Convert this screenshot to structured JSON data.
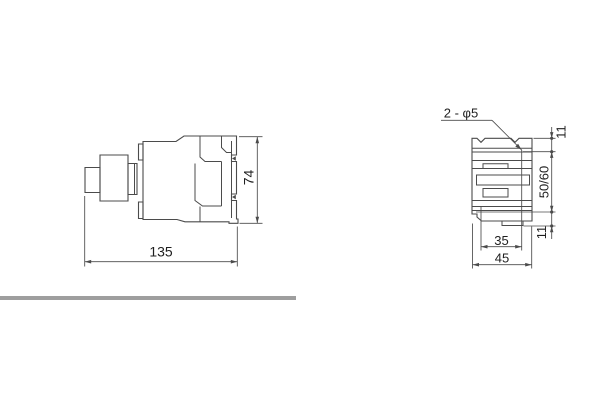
{
  "drawing": {
    "side_view": {
      "overall_width": "135",
      "overall_height": "74"
    },
    "front_view": {
      "hole_callout": "2 - φ5",
      "top_hole_offset": "11",
      "mounting_hole_spacing": "50/60",
      "bottom_hole_offset": "11",
      "hole_center_width": "35",
      "overall_width": "45"
    }
  },
  "colors": {
    "line": "#4b4b4b",
    "text": "#1f1f1f",
    "divider": "#9e9e9e",
    "background": "#ffffff"
  }
}
